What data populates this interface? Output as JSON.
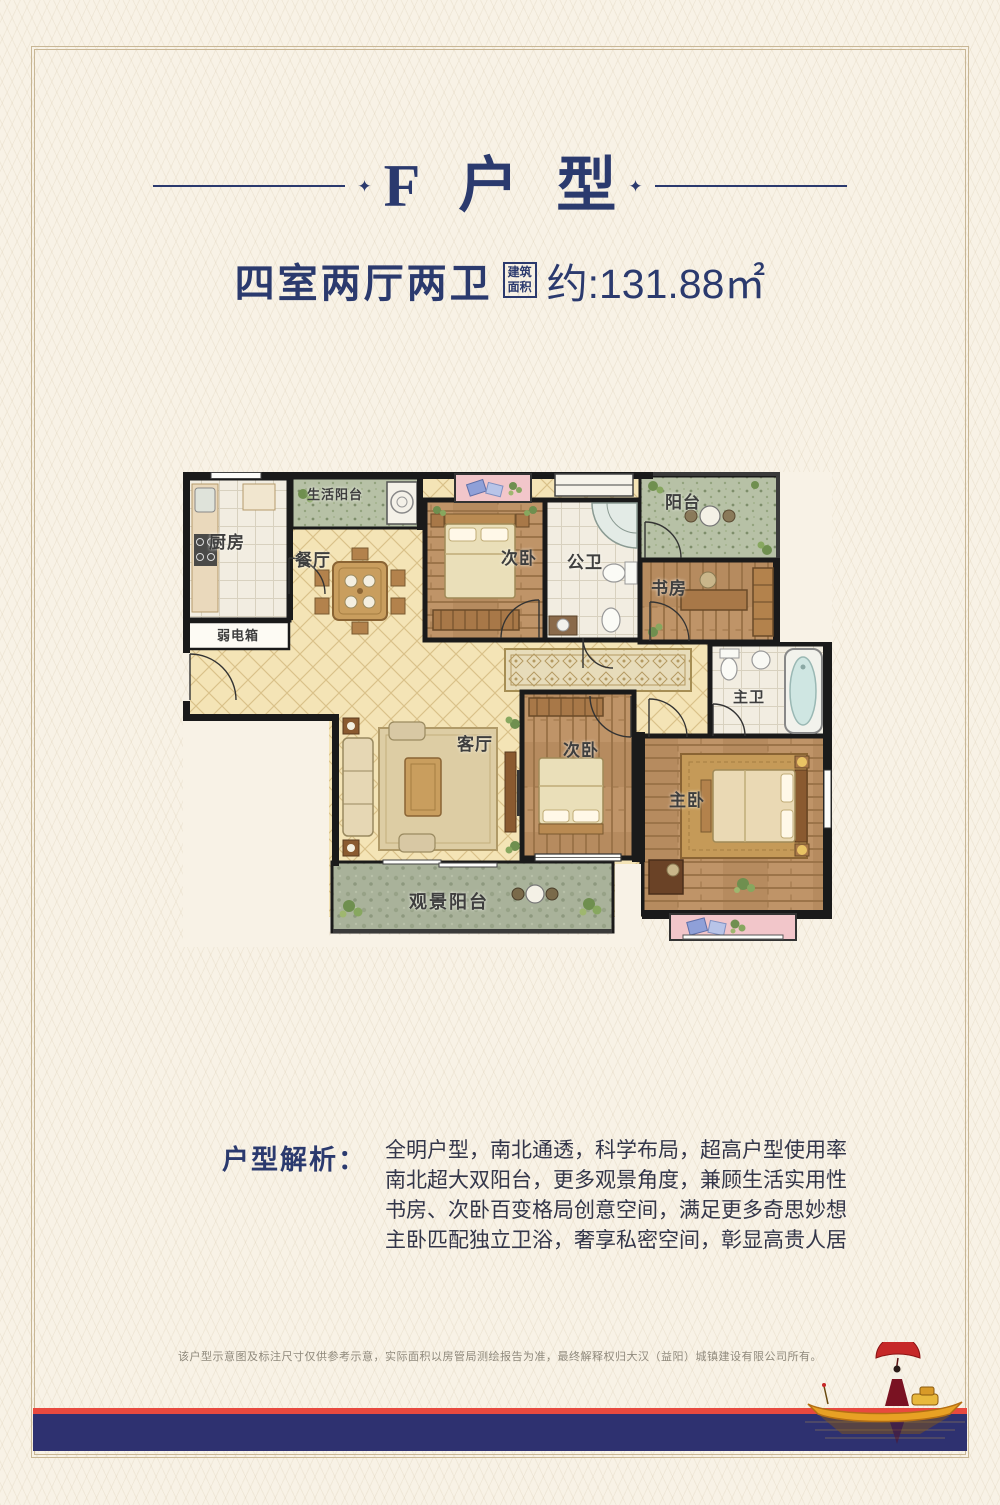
{
  "header": {
    "title": "F户型",
    "subtitle_rooms": "四室两厅两卫",
    "area_box": {
      "line1": "建筑",
      "line2": "面积"
    },
    "area_value": "约:131.88㎡"
  },
  "floorplan": {
    "rooms": [
      {
        "id": "kitchen",
        "label": "厨房"
      },
      {
        "id": "weak-current-box",
        "label": "弱电箱"
      },
      {
        "id": "service-balcony",
        "label": "生活阳台"
      },
      {
        "id": "dining-room",
        "label": "餐厅"
      },
      {
        "id": "bedroom2-north",
        "label": "次卧"
      },
      {
        "id": "public-bathroom",
        "label": "公卫"
      },
      {
        "id": "north-balcony",
        "label": "阳台"
      },
      {
        "id": "study",
        "label": "书房"
      },
      {
        "id": "master-bathroom",
        "label": "主卫"
      },
      {
        "id": "living-room",
        "label": "客厅"
      },
      {
        "id": "bedroom2-middle",
        "label": "次卧"
      },
      {
        "id": "master-bedroom",
        "label": "主卧"
      },
      {
        "id": "view-balcony",
        "label": "观景阳台"
      }
    ]
  },
  "analysis": {
    "heading": "户型解析：",
    "lines": [
      "全明户型，南北通透，科学布局，超高户型使用率",
      "南北超大双阳台，更多观景角度，兼顾生活实用性",
      "书房、次卧百变格局创意空间，满足更多奇思妙想",
      "主卧匹配独立卫浴，奢享私密空间，彰显高贵人居"
    ]
  },
  "footer": {
    "disclaimer": "该户型示意图及标注尺寸仅供参考示意，实际面积以房管局测绘报告为准，最终解释权归大汉（益阳）城镇建设有限公司所有。"
  },
  "colors": {
    "accent_navy": "#2b3a6e",
    "band_navy": "#2e3170",
    "band_red": "#e8493f",
    "frame_tan": "#c9b795",
    "wall_black": "#1a1a1a",
    "wood_floor": "#bf9468",
    "cream_tile": "#f4e4b6",
    "balcony_green": "#b7c1a6",
    "bay_pink": "#f2c6ca"
  }
}
